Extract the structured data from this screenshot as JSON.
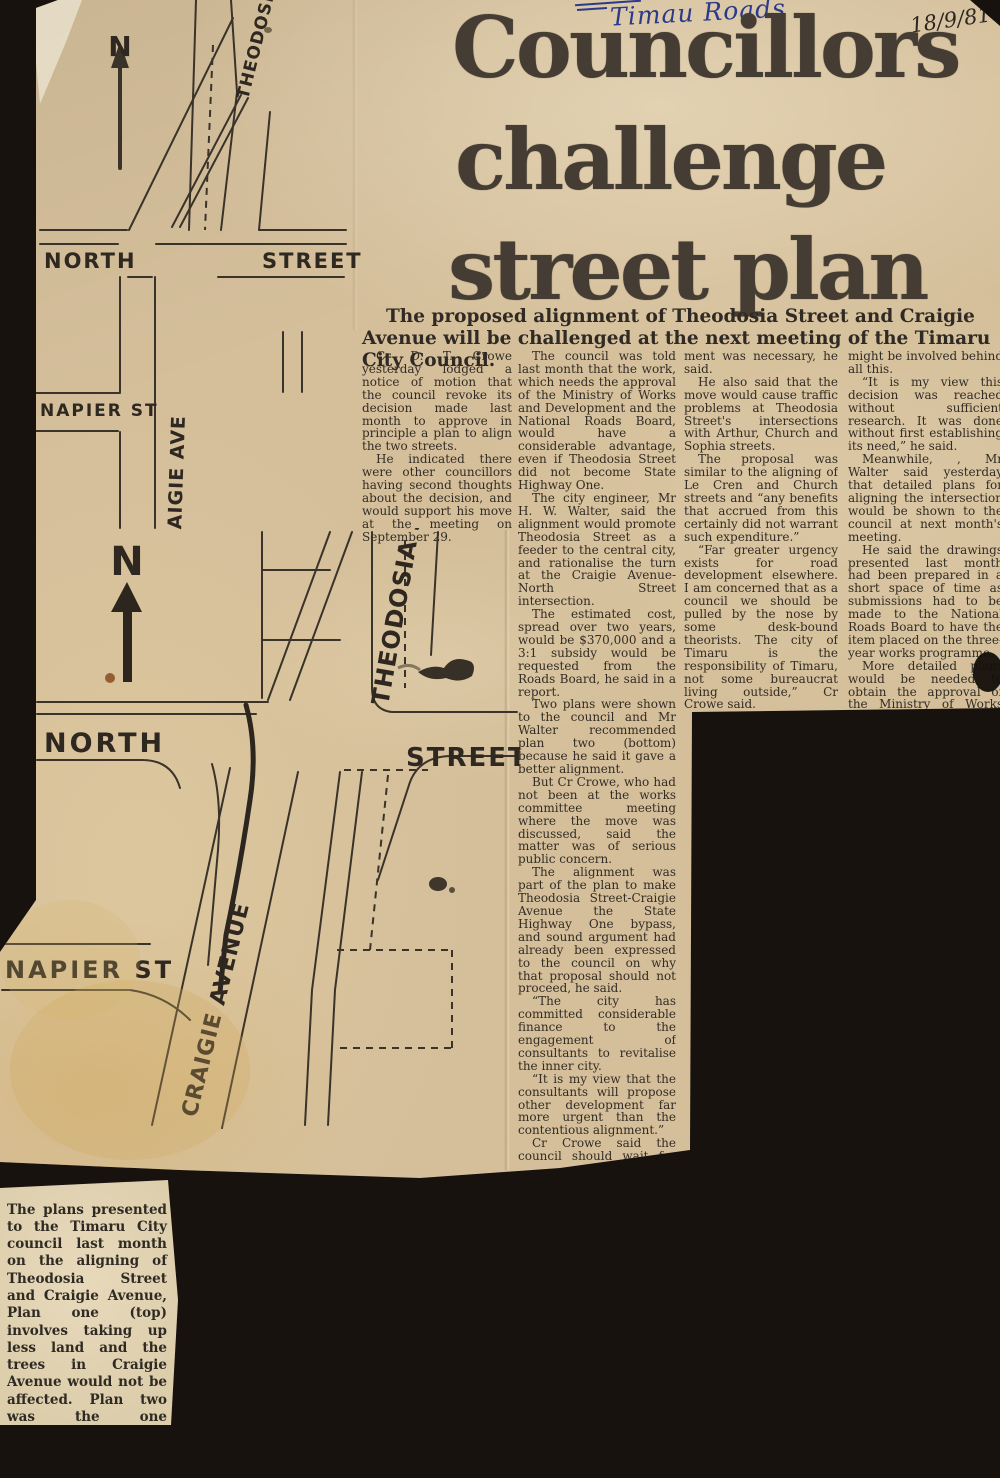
{
  "annotations": {
    "handwritten_note": "Timau Roads",
    "handwritten_date": "18/9/81"
  },
  "headline": {
    "line1": "Councillors",
    "line2": "challenge",
    "line3": "street plan"
  },
  "standfirst": "The proposed alignment of Theodosia Street and Craigie Avenue will be challenged at the next meeting of the Timaru City Council.",
  "article": {
    "col1": [
      "Cr D. T. Crowe yesterday lodged a notice of motion that the council revoke its decision made last month to approve in principle a plan to align the two streets.",
      "He indicated there were other councillors having second thoughts about the decision, and would support his move at the meeting on September 29."
    ],
    "col2": [
      "The council was told last month that the work, which needs the approval of the Ministry of Works and Development and the National Roads Board, would have a considerable advantage, even if Theodosia Street did not become State Highway One.",
      "The city engineer, Mr H. W. Walter, said the alignment would promote Theodosia Street as a feeder to the central city, and rationalise the turn at the Craigie Avenue-North Street intersection.",
      "The estimated cost, spread over two years, would be $370,000 and a 3:1 subsidy would be requested from the Roads Board, he said in a report.",
      "Two plans were shown to the council and Mr Walter recommended plan two (bottom) because he said it gave a better alignment.",
      "But Cr Crowe, who had not been at the works committee meeting where the move was discussed, said the matter was of serious public concern.",
      "The alignment was part of the plan to make Theodosia Street-Craigie Avenue the State Highway One bypass, and sound argument had already been expressed to the council on why that proposal should not proceed, he said.",
      "“The city has committed considerable finance to the engagement of consultants to revitalise the inner city.",
      "“It is my view that the consultants will propose other development far more urgent than the contentious alignment.”",
      "Cr Crowe said the council should wait for the report to be released so public money could be committed to where it would be in the city's best interests.",
      "To update only the intersection was unjustifiable. There had been no evidence that the align-"
    ],
    "col3": [
      "ment was necessary, he said.",
      "He also said that the move would cause traffic problems at Theodosia Street's intersections with Arthur, Church and Sophia streets.",
      "The proposal was similar to the aligning of Le Cren and Church streets and “any benefits that accrued from this certainly did not warrant such expenditure.”",
      "“Far greater urgency exists for road development elsewhere. I am concerned that as a council we should be pulled by the nose by some desk-bound theorists. The city of Timaru is the responsibility of Timaru, not some bureaucrat living outside,” Cr Crowe said.",
      "“I am extremely suspicious of what motives"
    ],
    "col4": [
      "might be involved behind all this.",
      "“It is my view this decision was reached without sufficient research. It was done without first establishing its need,” he said.",
      "Meanwhile, , Mr Walter said yesterday that detailed plans for aligning the intersection would be shown to the council at next month's meeting.",
      "He said the drawings presented last month had been prepared in a short space of time as submissions had to be made to the National Roads Board to have the item placed on the three-year works programme.",
      "More detailed plans would be needed to obtain the approval of the Ministry of Works and Development and it was those plans that would be submitted to the council."
    ]
  },
  "maps": {
    "plan_one": {
      "north": "N",
      "theodosia": "THEODOSIA ST",
      "street_left": "NORTH",
      "street_right": "STREET",
      "napier": "NAPIER ST",
      "craigie": "CRAIGIE AVE"
    },
    "plan_two": {
      "north": "N",
      "theodosia": "THEODOSIA ST",
      "street_left": "NORTH",
      "street_right": "STREET",
      "napier": "NAPIER ST",
      "craigie": "CRAIGIE AVENUE"
    }
  },
  "caption": "The plans presented to the Timaru City council last month on the aligning of Theodosia Street and Craigie Avenue, Plan one (top) involves taking up less land and the trees in Craigie Avenue would not be affected. Plan two was the one approved in principle by the council.",
  "colors": {
    "background": "#17120e",
    "paper": "#d5bf9b",
    "paper_caption": "#dccdab",
    "ink": "#322c24",
    "headline_ink": "#453d33",
    "pen_blue": "#2c3a8a"
  }
}
